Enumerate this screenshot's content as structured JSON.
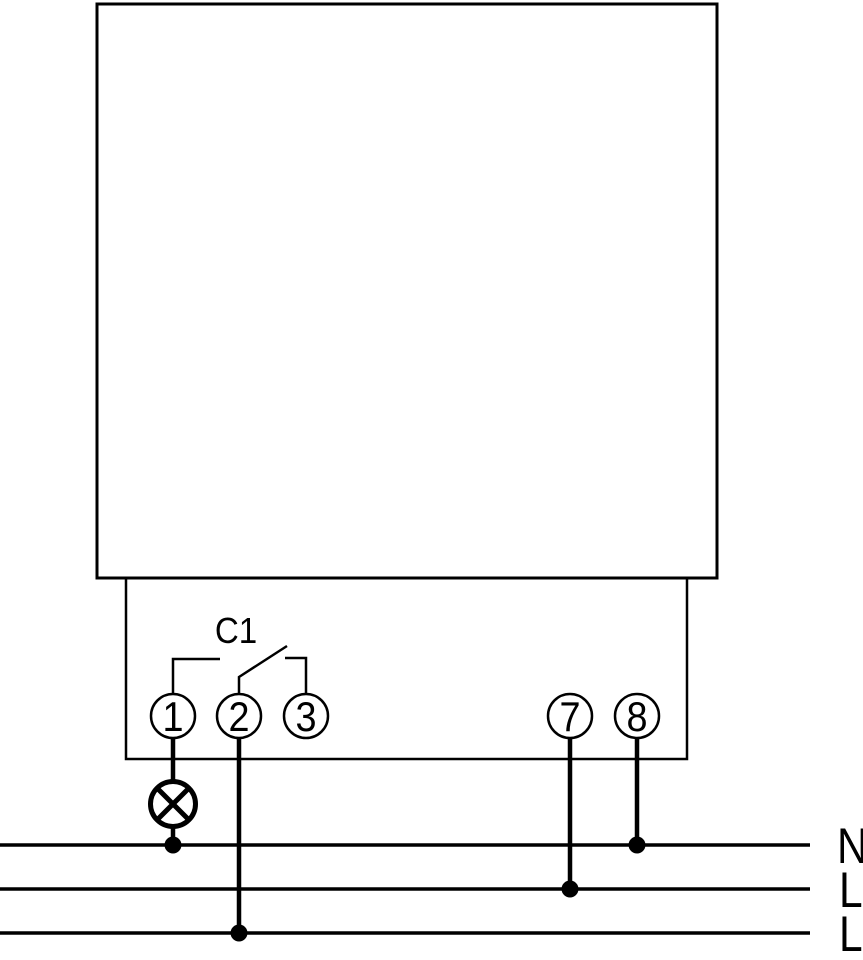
{
  "diagram": {
    "name": "timer-relay-wiring-diagram",
    "background_color": "#ffffff",
    "line_color": "#000000",
    "device": {
      "channel_label": "C1"
    },
    "terminals": [
      {
        "label": "1"
      },
      {
        "label": "2"
      },
      {
        "label": "3"
      },
      {
        "label": "7"
      },
      {
        "label": "8"
      }
    ],
    "bus_lines": [
      {
        "label": "N"
      },
      {
        "label": "L"
      },
      {
        "label": "L"
      }
    ],
    "symbols": {
      "lamp": "lamp-icon (circle with diagonal cross)",
      "switch": "open-relay-contact",
      "junction": "filled connection dot"
    }
  }
}
